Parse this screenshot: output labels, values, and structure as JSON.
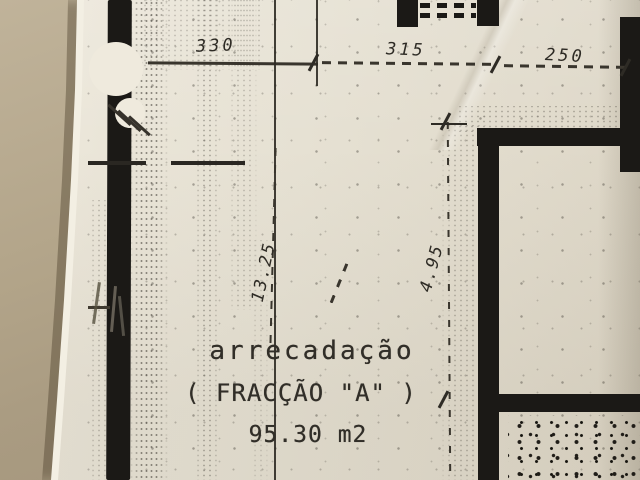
{
  "plan": {
    "room": {
      "name": "arrecadação",
      "fraction": "( FRACÇÃO \"A\" )",
      "area": "95.30 m2"
    },
    "dims": {
      "top": [
        "330",
        "315",
        "250"
      ],
      "left_height": "13.25",
      "right_height": "4.95"
    },
    "colors": {
      "ink": "#1b1916",
      "paper": "#e8e3d5",
      "table": "#ac9e84"
    }
  }
}
